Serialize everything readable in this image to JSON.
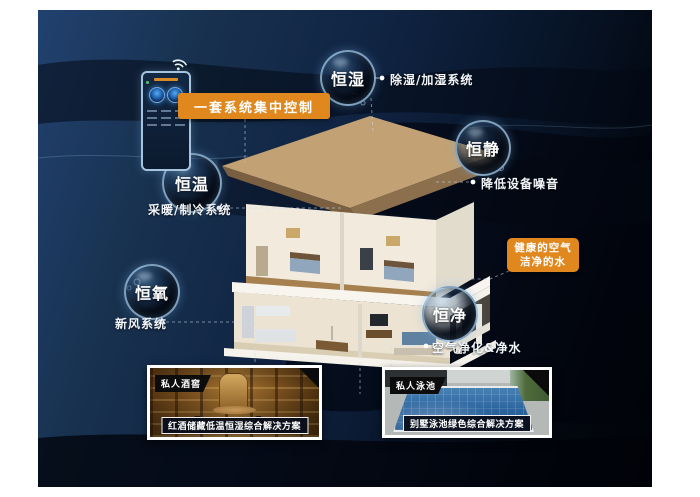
{
  "scene": {
    "bubbles": [
      {
        "label": "恒湿",
        "note": "除湿/加湿系统"
      },
      {
        "label": "恒静",
        "note": "降低设备噪音"
      },
      {
        "label": "恒温",
        "note": "采暖/制冷系统"
      },
      {
        "label": "恒氧",
        "note": "新风系统"
      },
      {
        "label": "恒净",
        "note": "空气净化&净水"
      }
    ],
    "control_label": "一套系统集中控制",
    "highlight_box": {
      "line1": "健康的空气",
      "line2": "洁净的水"
    },
    "cards": [
      {
        "tag": "私人酒窖",
        "caption": "红酒储藏低温恒湿综合解决方案"
      },
      {
        "tag": "私人泳池",
        "caption": "别墅泳池绿色综合解决方案"
      }
    ],
    "icons": {
      "wifi": "wifi-icon",
      "thermostat": "smart-control-panel"
    },
    "colors": {
      "accent_orange": "#e0871d",
      "background_navy": "#16294a",
      "bubble_rim": "#a9cdea",
      "badge_black": "#0c0c0c",
      "pool_blue": "#2b639c",
      "cellar_wood": "#8a5c24"
    }
  }
}
